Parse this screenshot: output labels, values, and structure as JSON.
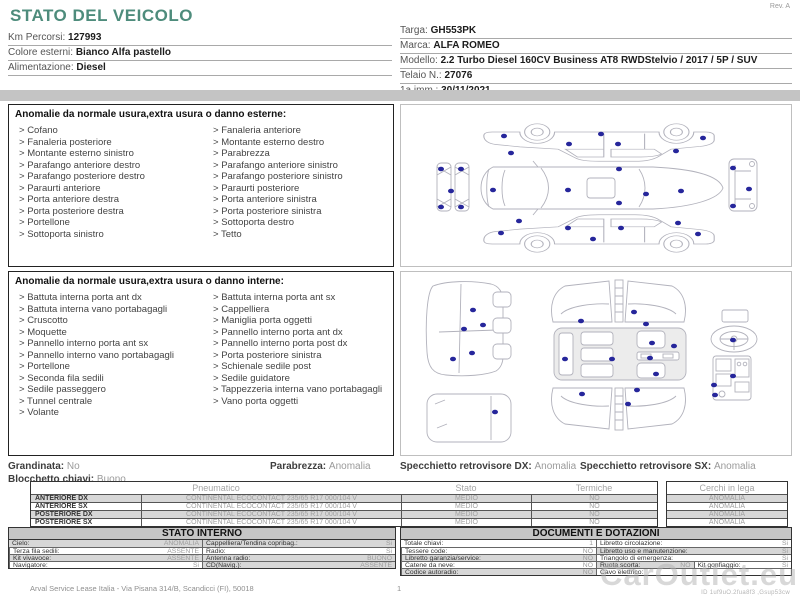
{
  "header": {
    "title": "STATO DEL VEICOLO",
    "rev": "Rev. A",
    "left_rows": [
      {
        "label": "Km Percorsi: ",
        "value": "127993"
      },
      {
        "label": "Colore esterni: ",
        "value": "Bianco Alfa pastello"
      },
      {
        "label": "Alimentazione: ",
        "value": "Diesel"
      }
    ],
    "right_rows": [
      {
        "label": "Targa: ",
        "value": "GH553PK"
      },
      {
        "label": "Marca: ",
        "value": "ALFA ROMEO"
      },
      {
        "label": "Modello: ",
        "value": "2.2 Turbo Diesel 160CV Business AT8 RWDStelvio / 2017 / 5P / SUV"
      },
      {
        "label": "Telaio N.: ",
        "value": "27076"
      },
      {
        "label": "1a imm.: ",
        "value": "30/11/2021",
        "cls": "teal"
      }
    ]
  },
  "anomalies_external": {
    "title": "Anomalie da normale usura,extra usura o danno esterne:",
    "col1": [
      "Cofano",
      "Fanaleria posteriore",
      "Montante esterno sinistro",
      "Parafango anteriore destro",
      "Parafango posteriore destro",
      "Paraurti anteriore",
      "Porta anteriore destra",
      "Porta posteriore destra",
      "Portellone",
      "Sottoporta sinistro"
    ],
    "col2": [
      "Fanaleria anteriore",
      "Montante esterno destro",
      "Parabrezza",
      "Parafango anteriore sinistro",
      "Parafango posteriore sinistro",
      "Paraurti posteriore",
      "Porta anteriore sinistra",
      "Porta posteriore sinistra",
      "Sottoporta destro",
      "Tetto"
    ]
  },
  "anomalies_internal": {
    "title": "Anomalie da normale usura,extra usura o danno interne:",
    "col1": [
      "Battuta interna porta ant dx",
      "Battuta interna vano portabagagli",
      "Cruscotto",
      "Moquette",
      "Pannello interno porta ant sx",
      "Pannello interno vano portabagagli",
      "Portellone",
      "Seconda fila sedili",
      "Sedile passeggero",
      "Tunnel centrale",
      "Volante"
    ],
    "col2": [
      "Battuta interna porta ant sx",
      "Cappelliera",
      "Maniglia porta oggetti",
      "Pannello interno porta ant dx",
      "Pannello interno porta post dx",
      "Porta posteriore sinistra",
      "Schienale sedile post",
      "Sedile guidatore",
      "Tappezzeria interna vano portabagagli",
      "Vano porta oggetti"
    ]
  },
  "vehicle_status": {
    "items": [
      {
        "label": "Grandinata: ",
        "value": "No"
      },
      {
        "label": "Blocchetto chiavi: ",
        "value": "Buono"
      },
      {
        "label": "Parabrezza: ",
        "value": "Anomalia"
      },
      {
        "label": "Specchietto retrovisore DX: ",
        "value": "Anomalia"
      },
      {
        "label": "Specchietto retrovisore SX: ",
        "value": "Anomalia"
      }
    ]
  },
  "tires": {
    "headers": {
      "pneumatico": "Pneumatico",
      "stato": "Stato",
      "termiche": "Termiche",
      "cerchi": "Cerchi in lega"
    },
    "rows": [
      {
        "position": "ANTERIORE DX",
        "tire": "CONTINENTAL ECOCONTACT 235/65 R17 000/104 V",
        "stato": "MEDIO",
        "termiche": "NO"
      },
      {
        "position": "ANTERIORE SX",
        "tire": "CONTINENTAL ECOCONTACT 235/65 R17 000/104 V",
        "stato": "MEDIO",
        "termiche": "NO"
      },
      {
        "position": "POSTERIORE DX",
        "tire": "CONTINENTAL ECOCONTACT 235/65 R17 000/104 V",
        "stato": "MEDIO",
        "termiche": "NO"
      },
      {
        "position": "POSTERIORE SX",
        "tire": "CONTINENTAL ECOCONTACT 235/65 R17 000/104 V",
        "stato": "MEDIO",
        "termiche": "NO"
      }
    ],
    "cerchi_values": [
      "ANOMALIA",
      "ANOMALIA",
      "ANOMALIA",
      "ANOMALIA"
    ]
  },
  "stato_interno": {
    "title": "STATO INTERNO",
    "cells": [
      {
        "label": "Cielo:",
        "value": "ANOMALIA",
        "cls": "half g"
      },
      {
        "label": "Cappelliera/Tendina copribag.:",
        "value": "Si",
        "cls": "half g"
      },
      {
        "label": "Terza fila sedili:",
        "value": "ASSENTE",
        "cls": "half"
      },
      {
        "label": "Radio:",
        "value": "Si",
        "cls": "half"
      },
      {
        "label": "Kit vivavoce:",
        "value": "ASSENTE",
        "cls": "half g"
      },
      {
        "label": "Antenna radio:",
        "value": "BUONO",
        "cls": "half g"
      },
      {
        "label": "Navigatore:",
        "value": "Si",
        "cls": "half"
      },
      {
        "label": "CD(Navig.):",
        "value": "ASSENTE",
        "cls": "half g"
      }
    ]
  },
  "documenti": {
    "title": "DOCUMENTI E DOTAZIONI",
    "cells": [
      {
        "label": "Totale chiavi:",
        "value": "1",
        "cls": "half"
      },
      {
        "label": "Libretto circolazione:",
        "value": "Si",
        "cls": "half"
      },
      {
        "label": "Tessere code:",
        "value": "NO",
        "cls": "half"
      },
      {
        "label": "Libretto uso e manutenzione:",
        "value": "Si",
        "cls": "half g"
      },
      {
        "label": "Libretto garanzia/service:",
        "value": "NO",
        "cls": "half g"
      },
      {
        "label": "Triangolo di emergenza:",
        "value": "Si",
        "cls": "half"
      },
      {
        "label": "Catene da neve:",
        "value": "NO",
        "cls": "half"
      },
      {
        "label": "Ruota scorta:",
        "value": "NO",
        "cls": "quarter g"
      },
      {
        "label": "Kit gonfiaggio:",
        "value": "Si",
        "cls": "quarter"
      },
      {
        "label": "Codice autoradio:",
        "value": "NO",
        "cls": "half g"
      },
      {
        "label": "Cavo elettrico:",
        "value": "",
        "cls": "half"
      }
    ]
  },
  "footer": {
    "address": "Arval Service Lease Italia - Via Pisana 314/B, Scandicci (FI), 50018",
    "page": "1",
    "doc_id": "ID 1uf9uO.2fua8f3 ,Gsup53cw",
    "watermark": "CarOutlet.eu"
  },
  "colors": {
    "title_teal": "#4e8c7c",
    "damage_marker_blue": "#26269b",
    "table_stripe_gray": "#d7d7d7",
    "band_gray": "#c4c4c4",
    "value_gray": "#9d9d9d",
    "watermark_gray": "#b2b2b2"
  }
}
